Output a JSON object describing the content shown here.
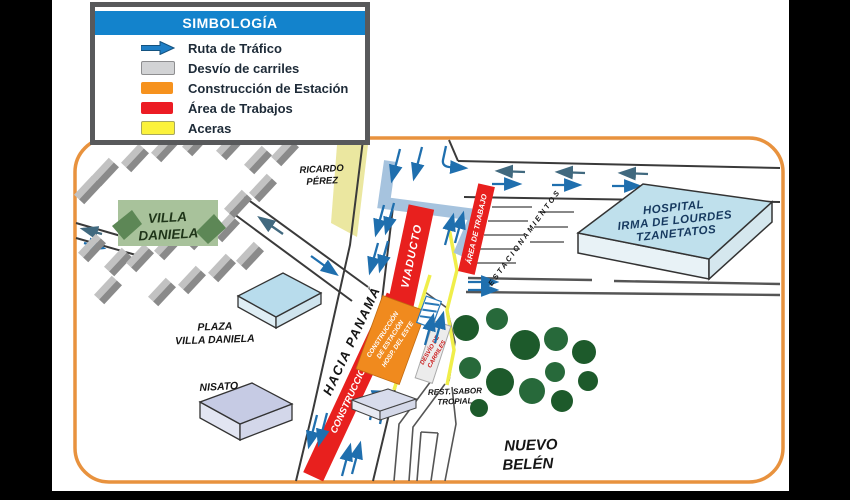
{
  "legend": {
    "title": "SIMBOLOGÍA",
    "items": [
      {
        "name": "traffic-route",
        "label": "Ruta de Tráfico",
        "icon": "blue-arrow-right-icon",
        "color": "#1F7FC6"
      },
      {
        "name": "lane-detour",
        "label": "Desvío de carriles",
        "icon": "gray-swatch",
        "color": "#D2D3D5"
      },
      {
        "name": "station-construction",
        "label": "Construcción de Estación",
        "icon": "orange-swatch",
        "color": "#F6921E"
      },
      {
        "name": "work-area",
        "label": "Área de Trabajos",
        "icon": "red-swatch",
        "color": "#EC1C24"
      },
      {
        "name": "sidewalks",
        "label": "Aceras",
        "icon": "yellow-swatch",
        "color": "#FBF23B"
      }
    ]
  },
  "map": {
    "labels": {
      "villa_daniela": {
        "lines": [
          "VILLA",
          "DANIELA"
        ]
      },
      "ricardo_perez": {
        "lines": [
          "RICARDO",
          "PÉREZ"
        ]
      },
      "hospital": {
        "lines": [
          "HOSPITAL",
          "IRMA DE LOURDES",
          "TZANETATOS"
        ]
      },
      "plaza_villa_daniela": {
        "lines": [
          "PLAZA",
          "VILLA DANIELA"
        ]
      },
      "nisato": {
        "text": "NISATO"
      },
      "nuevo_belen": {
        "lines": [
          "NUEVO",
          "BELÉN"
        ]
      },
      "rest_sabor_tropial": {
        "lines": [
          "REST. SABOR",
          "TROPIAL"
        ]
      },
      "hacia_panama": {
        "text": "HACIA  PANAMÁ"
      },
      "viaducto": {
        "text": "VIADUCTO"
      },
      "construccion_de": {
        "text": "CONSTRUCCIÓN DE"
      },
      "area_de_trabajo": {
        "text": "ÁREA DE TRABAJO"
      },
      "estacionamientos": {
        "text": "ESTACIONAMIENTOS"
      },
      "station_box": {
        "lines": [
          "CONSTRUCCIÓN",
          "DE ESTACIÓN",
          "HOSP. DEL ESTE"
        ]
      },
      "desvio_de_carriles": {
        "lines": [
          "DESVÍO DE",
          "CARRILES"
        ]
      }
    },
    "colors": {
      "border_orange": "#E8923E",
      "work_area_red": "#E8201E",
      "station_orange": "#F08A1E",
      "sidewalk_yellow": "#F0EE4A",
      "detour_blue": "#A6C3DE",
      "arrow_blue": "#1F6FAE",
      "arrow_dark": "#41697F",
      "tree_green": "#1D5A2B",
      "hospital_blue": "#BFE0EC",
      "legend_header_blue": "#1383CC"
    }
  }
}
